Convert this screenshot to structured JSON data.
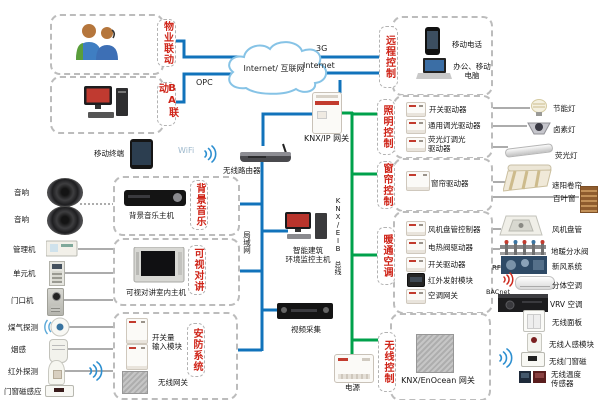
{
  "cloud_label": "Internet/ 互联网",
  "links": {
    "g3": "3G",
    "internet": "Internet",
    "opc": "OPC",
    "wifi": "WiFi",
    "lan": "局域网",
    "knx_bus": "KNX/EIB 总线",
    "rf": "RF",
    "bacnet": "BACnet"
  },
  "core": {
    "knx_ip": "KNX/IP 网关",
    "router": "无线路由器",
    "tablet": "移动终端",
    "host": "智能建筑\n环境监控主机",
    "dvr": "视频采集",
    "power": "电源"
  },
  "property": {
    "label": "物业联动"
  },
  "ba": {
    "label": "BA联动"
  },
  "music": {
    "label": "背景音乐",
    "host": "背景音乐主机"
  },
  "intercom": {
    "label": "可视对讲",
    "host": "可视对讲室内主机"
  },
  "security": {
    "label": "安防系统",
    "input_module": "开关量\n输入模块",
    "wireless_gw": "无线网关"
  },
  "left_devices": {
    "speaker1": "音响",
    "speaker2": "音响",
    "manager": "管理机",
    "unit": "单元机",
    "door": "门口机",
    "gas": "煤气探测",
    "smoke": "烟感",
    "pir": "红外探测",
    "magnet": "门窗磁感应"
  },
  "remote": {
    "label": "远程控制",
    "phone": "移动电话",
    "laptop": "办公、移动\n电脑"
  },
  "lighting": {
    "label": "照明控制",
    "items": [
      "开关驱动器",
      "通用调光驱动器",
      "荧光灯调光\n驱动器"
    ],
    "devices": [
      "节能灯",
      "卤素灯",
      "荧光灯"
    ]
  },
  "curtain": {
    "label": "窗帘控制",
    "items": [
      "窗帘驱动器"
    ],
    "devices": [
      "遮阳卷帘",
      "百叶窗"
    ]
  },
  "hvac": {
    "label": "暖通空调",
    "items": [
      "风机盘管控制器",
      "电热阀驱动器",
      "开关驱动器",
      "红外发射模块",
      "空调网关"
    ],
    "devices": [
      "风机盘管",
      "地暖分水阀",
      "新风系统",
      "分体空调",
      "VRV 空调"
    ]
  },
  "wireless": {
    "label": "无线控制",
    "gateway": "KNX/EnOcean 网关",
    "devices": [
      "无线面板",
      "无线人感模块",
      "无线门窗磁",
      "无线温度\n传感器"
    ]
  }
}
